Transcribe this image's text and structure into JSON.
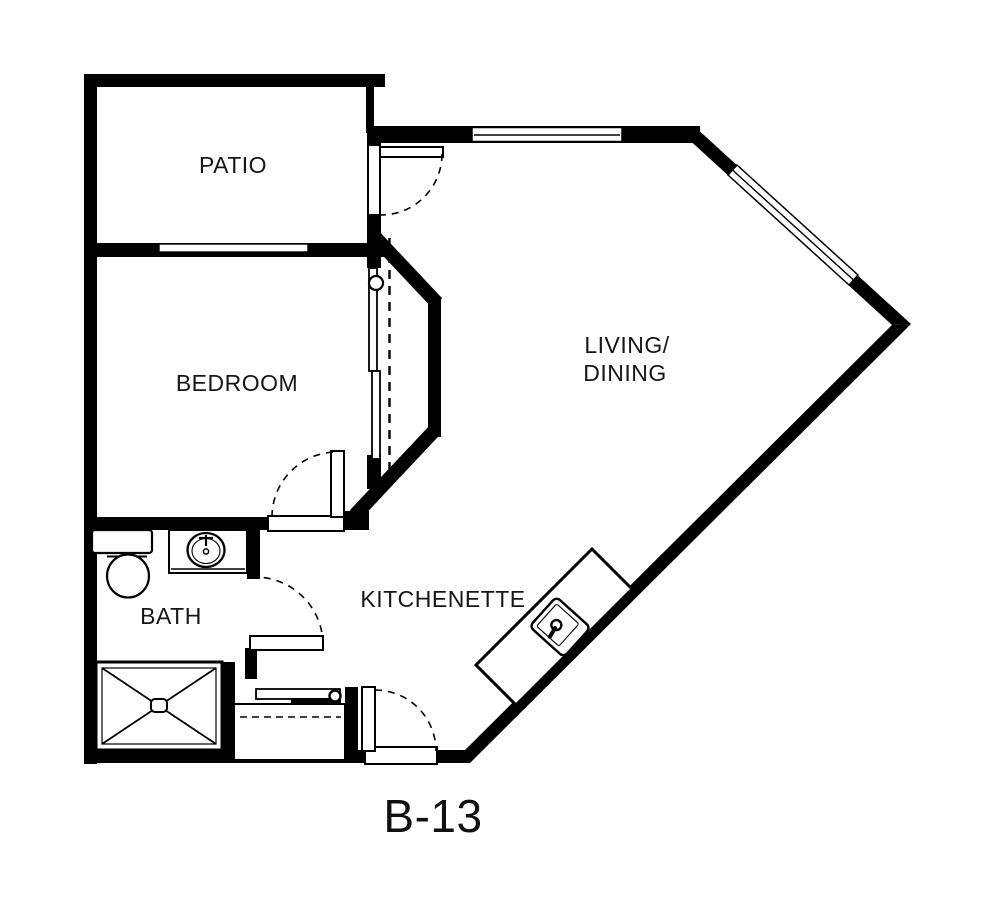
{
  "document": {
    "type": "floor-plan",
    "unit_label": "B-13"
  },
  "rooms": {
    "patio": {
      "label": "PATIO"
    },
    "bedroom": {
      "label": "BEDROOM"
    },
    "living_dining": {
      "line1": "LIVING/",
      "line2": "DINING"
    },
    "bath": {
      "label": "BATH"
    },
    "kitchenette": {
      "label": "KITCHENETTE"
    }
  },
  "fixtures": {
    "bath": [
      "toilet-icon",
      "vanity-sink-icon",
      "shower-icon"
    ],
    "closet": [
      "hanging-rod-icon",
      "shelf-dashed-line"
    ],
    "kitchenette": [
      "island-counter",
      "kitchen-sink-icon"
    ],
    "doors": [
      "patio-door-swing",
      "bedroom-door-swing",
      "bath-door-swing",
      "entry-door-swing",
      "bedroom-sliding-doors"
    ]
  },
  "colors": {
    "walls": "#000000",
    "background": "#ffffff",
    "text": "#161616"
  }
}
